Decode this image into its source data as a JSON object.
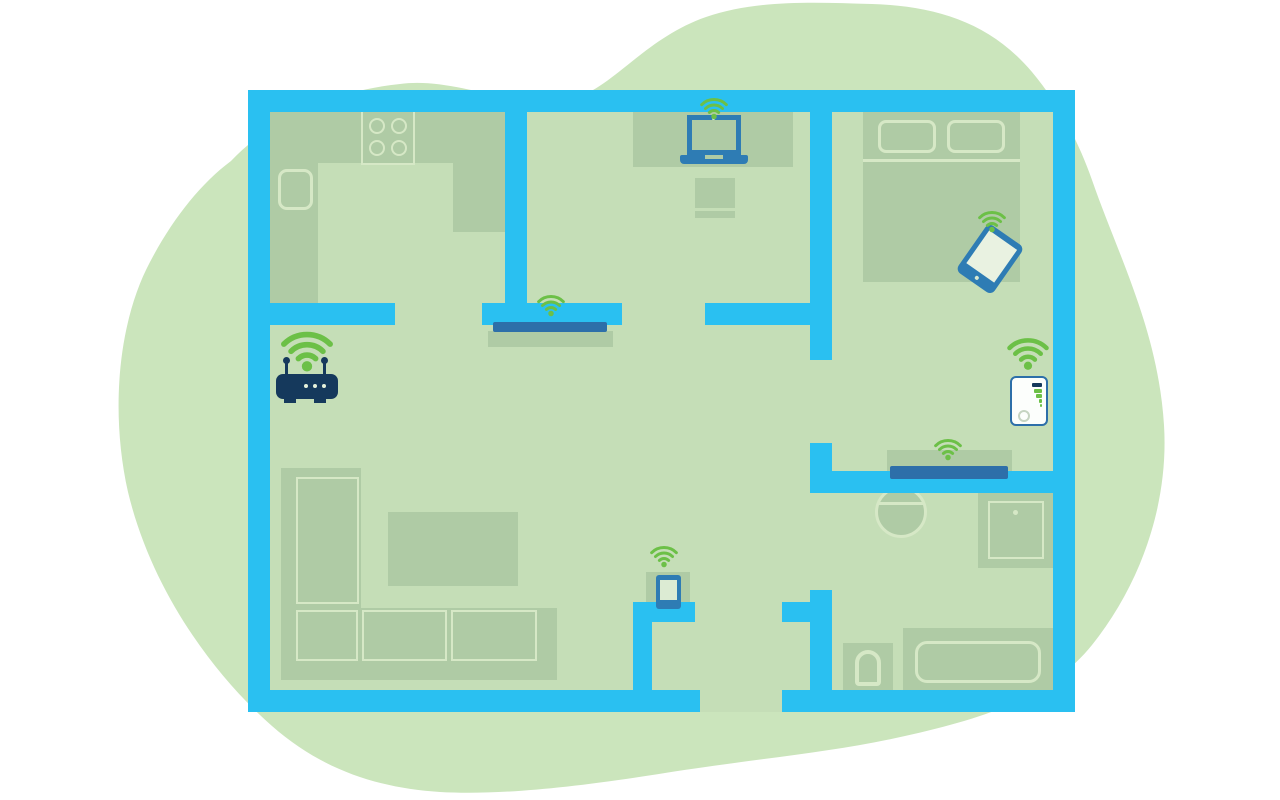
{
  "scene": {
    "label": "home-floorplan-wifi-coverage-illustration"
  },
  "colors": {
    "background": "#ffffff",
    "blob": "#cbe5bc",
    "floor": "#c5deb7",
    "furniture": "#afcba5",
    "outline": "#d6e8c6",
    "wall": "#2ac0f1",
    "device": "#2e7cb4",
    "tv": "#2d6fa9",
    "navy": "#15395c",
    "wifi": "#6cc047",
    "extender": "#fcfefc",
    "button": "#c6d4c2"
  },
  "devices": {
    "router": {
      "label": "wifi-router"
    },
    "laptop": {
      "label": "laptop-on-desk"
    },
    "tablet": {
      "label": "tablet-on-bed"
    },
    "phone": {
      "label": "smartphone-on-side-table"
    },
    "extender": {
      "label": "wifi-range-extender"
    },
    "tv_living": {
      "label": "wall-mounted-tv-living-area"
    },
    "tv_bedroom": {
      "label": "tv-on-shelf-bedroom"
    }
  },
  "wifi": {
    "label": "wifi-signal",
    "count": 7
  }
}
